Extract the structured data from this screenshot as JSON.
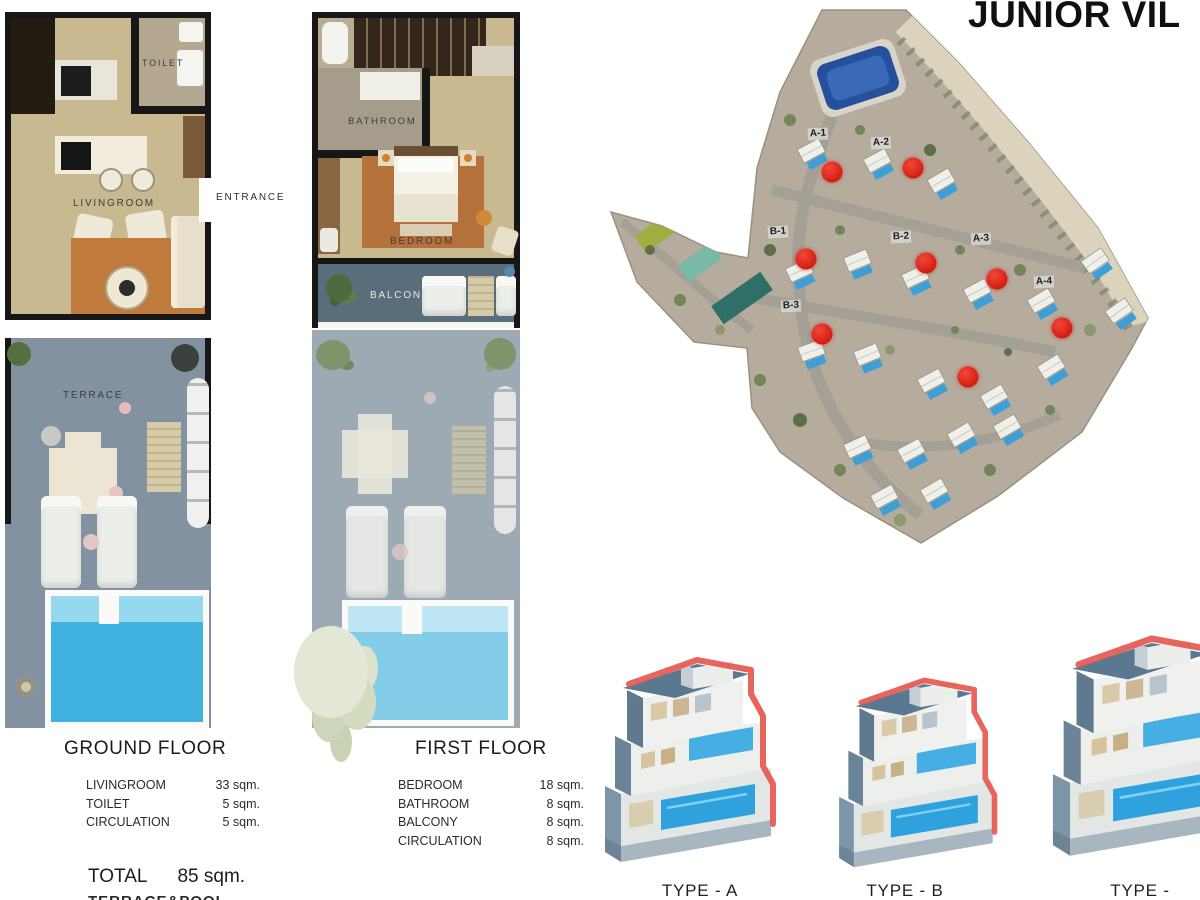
{
  "page_title": "JUNIOR VIL",
  "ground_floor": {
    "heading": "GROUND FLOOR",
    "plan_labels": {
      "toilet": "TOILET",
      "livingroom": "LIVINGROOM",
      "entrance": "ENTRANCE",
      "terrace": "TERRACE"
    },
    "rooms": [
      {
        "name": "LIVINGROOM",
        "area": "33 sqm."
      },
      {
        "name": "TOILET",
        "area": "5 sqm."
      },
      {
        "name": "CIRCULATION",
        "area": "5 sqm."
      }
    ],
    "total_label": "TOTAL",
    "total_value": "85 sqm.",
    "clipped_line": "TERRACE&POOL"
  },
  "first_floor": {
    "heading": "FIRST FLOOR",
    "plan_labels": {
      "bathroom": "BATHROOM",
      "bedroom": "BEDROOM",
      "balcony": "BALCONY"
    },
    "rooms": [
      {
        "name": "BEDROOM",
        "area": "18 sqm."
      },
      {
        "name": "BATHROOM",
        "area": "8 sqm."
      },
      {
        "name": "BALCONY",
        "area": "8 sqm."
      },
      {
        "name": "CIRCULATION",
        "area": "8 sqm."
      }
    ]
  },
  "site_map": {
    "marker_color": "#d9251a",
    "unit_labels": [
      {
        "label": "A-1",
        "x": 818,
        "y": 134
      },
      {
        "label": "A-2",
        "x": 881,
        "y": 143
      },
      {
        "label": "B-1",
        "x": 778,
        "y": 232
      },
      {
        "label": "B-2",
        "x": 901,
        "y": 237
      },
      {
        "label": "A-3",
        "x": 981,
        "y": 239
      },
      {
        "label": "A-4",
        "x": 1044,
        "y": 282
      },
      {
        "label": "B-3",
        "x": 791,
        "y": 306
      }
    ],
    "markers": [
      {
        "x": 832,
        "y": 172
      },
      {
        "x": 913,
        "y": 168
      },
      {
        "x": 806,
        "y": 259
      },
      {
        "x": 926,
        "y": 263
      },
      {
        "x": 997,
        "y": 279
      },
      {
        "x": 1062,
        "y": 328
      },
      {
        "x": 822,
        "y": 334
      },
      {
        "x": 968,
        "y": 377
      }
    ]
  },
  "villa_types": [
    {
      "label": "TYPE - A"
    },
    {
      "label": "TYPE - B"
    },
    {
      "label": "TYPE -"
    }
  ]
}
